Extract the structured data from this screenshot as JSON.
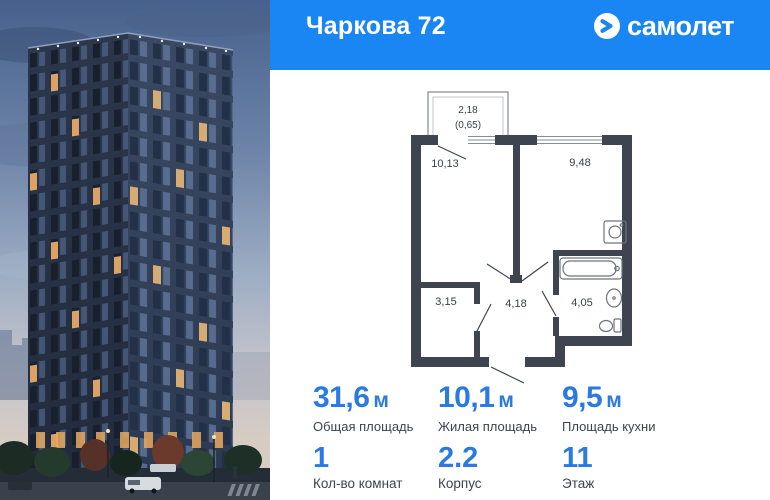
{
  "header": {
    "title": "Чаркова 72",
    "brand": "самолет"
  },
  "floorplan": {
    "balcony_area": "2,18",
    "balcony_area_reduced": "(0,65)",
    "rooms": [
      {
        "id": "living-room",
        "area": "10,13"
      },
      {
        "id": "kitchen",
        "area": "9,48"
      },
      {
        "id": "wardrobe",
        "area": "3,15"
      },
      {
        "id": "hallway",
        "area": "4,18"
      },
      {
        "id": "bathroom",
        "area": "4,05"
      }
    ]
  },
  "stats": [
    {
      "value": "31,6",
      "unit": "м",
      "label": "Общая площадь"
    },
    {
      "value": "10,1",
      "unit": "м",
      "label": "Жилая площадь"
    },
    {
      "value": "9,5",
      "unit": "м",
      "label": "Площадь кухни"
    }
  ],
  "details": [
    {
      "value": "1",
      "label": "Кол-во комнат"
    },
    {
      "value": "2.2",
      "label": "Корпус"
    },
    {
      "value": "11",
      "label": "Этаж"
    }
  ],
  "colors": {
    "header_blue": "#1986f4",
    "accent_blue": "#2a7ae2",
    "wall_dark": "#3e4450"
  }
}
